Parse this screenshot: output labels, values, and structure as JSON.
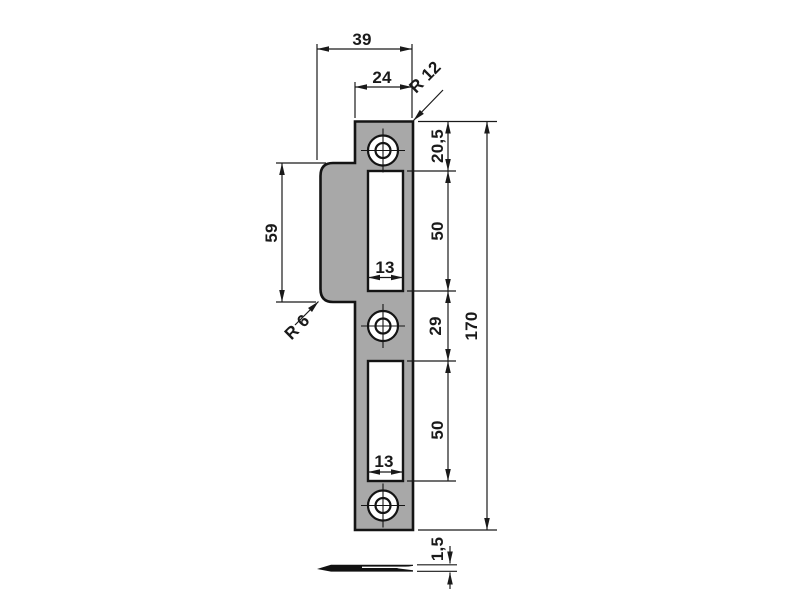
{
  "drawing": {
    "type": "technical-drawing",
    "part": "door-lock-strike-plate",
    "views": {
      "front": "front-view-with-lip-two-slots-three-screw-holes",
      "side": "edge-view-thickness"
    },
    "colors": {
      "plate_fill": "#a8a8a8",
      "line": "#1a1a1a",
      "background": "#ffffff"
    },
    "dimensions": {
      "overall_width": "39",
      "plate_width": "24",
      "corner_radius": "R 12",
      "lip_height": "59",
      "lip_radius": "R 6",
      "top_offset": "20,5",
      "upper_slot_height": "50",
      "upper_slot_width": "13",
      "center_offset": "29",
      "lower_slot_height": "50",
      "lower_slot_width": "13",
      "overall_height": "170",
      "thickness": "1,5"
    }
  }
}
